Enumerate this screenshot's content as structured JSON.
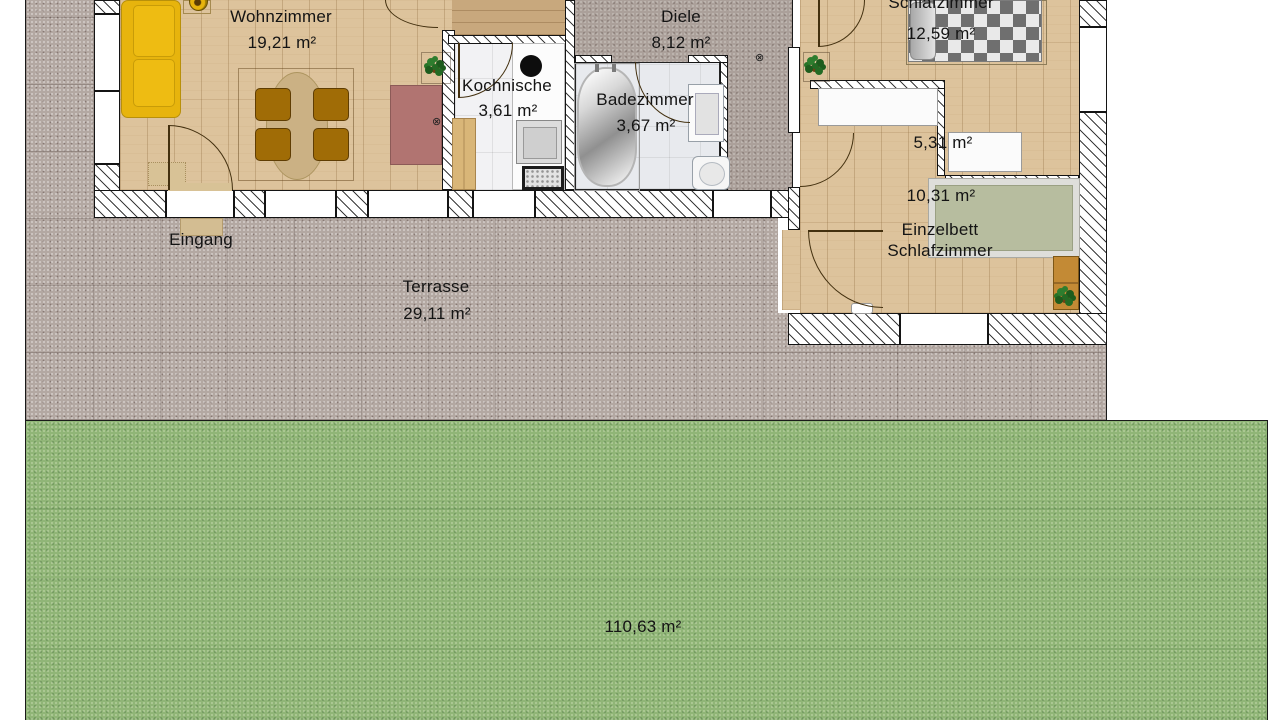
{
  "rooms": {
    "wohnzimmer": {
      "label": "Wohnzimmer",
      "area": "19,21 m²"
    },
    "diele": {
      "label": "Diele",
      "area": "8,12 m²"
    },
    "kochnische": {
      "label": "Kochnische",
      "area": "3,61 m²"
    },
    "badezimmer": {
      "label": "Badezimmer",
      "area": "3,67 m²"
    },
    "schlafzimmer": {
      "label": "Schlafzimmer",
      "area": "12,59 m²"
    },
    "flur": {
      "area": "5,31 m²"
    },
    "einzelbett_schlafzimmer": {
      "label_line1": "Einzelbett",
      "label_line2": "Schlafzimmer",
      "area": "10,31 m²"
    },
    "eingang": {
      "label": "Eingang"
    },
    "terrasse": {
      "label": "Terrasse",
      "area": "29,11 m²"
    },
    "garten": {
      "area": "110,63 m²"
    }
  },
  "colors": {
    "wood_floor": "#ddc39c",
    "wood_floor_dark": "#c8a87d",
    "tile_kitchen": "#f2f2f4",
    "tile_bath": "#e8eaee",
    "stone_diele": "#aba09a",
    "stone_terrace": "#b3a8a2",
    "grass": "#90b577",
    "sofa_yellow": "#e7b40d",
    "chair_brown": "#a06c06",
    "table_tan": "#cbb184",
    "rug_red": "#b17471",
    "bed_blanket_gray": "#6f6f6f",
    "bed_single_green": "#b7bd9f",
    "wall_line": "#141414"
  }
}
